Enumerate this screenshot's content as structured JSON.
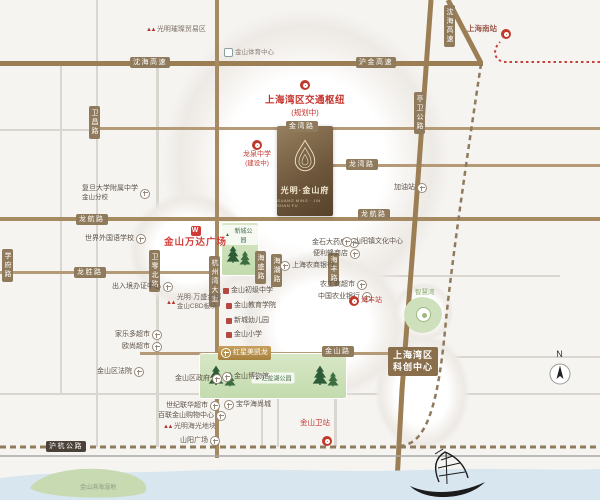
{
  "colors": {
    "accent_red": "#c23b35",
    "road_brown": "#9c7e55",
    "badge_brown": "#8f7a5c",
    "park_green": "#cfe0bd",
    "water_blue": "#d8e6ef",
    "gold": "#b8935a"
  },
  "map": {
    "compass_n": "N",
    "project": {
      "name": "光明·金山府",
      "name_en": "GUANG MING · JIN SHAN FU"
    },
    "hub": {
      "line1": "上海湾区交通枢纽",
      "line2": "(规划中)"
    },
    "kechuang": {
      "line1": "上海湾区",
      "line2": "科创中心"
    },
    "parks": {
      "xincheng": "新城公园",
      "huilong": "汇龙湖公园"
    },
    "road_badges": [
      {
        "text": "沈海高速",
        "x": 130,
        "y": 57
      },
      {
        "text": "沪金高速",
        "x": 356,
        "y": 57
      },
      {
        "text": "沈海高速",
        "x": 444,
        "y": 5,
        "vertical": true
      },
      {
        "text": "亭卫公路",
        "x": 414,
        "y": 92,
        "vertical": true
      },
      {
        "text": "卫昌路",
        "x": 89,
        "y": 106,
        "vertical": true
      },
      {
        "text": "金湾路",
        "x": 286,
        "y": 121
      },
      {
        "text": "龙湾路",
        "x": 346,
        "y": 159
      },
      {
        "text": "龙航路",
        "x": 76,
        "y": 214
      },
      {
        "text": "龙航路",
        "x": 358,
        "y": 209
      },
      {
        "text": "龙胜路",
        "x": 74,
        "y": 267
      },
      {
        "text": "学府路",
        "x": 2,
        "y": 249,
        "vertical": true
      },
      {
        "text": "卫零北路",
        "x": 149,
        "y": 250,
        "vertical": true
      },
      {
        "text": "杭州湾大道",
        "x": 209,
        "y": 256,
        "vertical": true
      },
      {
        "text": "海盛路",
        "x": 255,
        "y": 251,
        "vertical": true
      },
      {
        "text": "海潮路",
        "x": 271,
        "y": 254,
        "vertical": true
      },
      {
        "text": "海丰路",
        "x": 328,
        "y": 253,
        "vertical": true
      },
      {
        "text": "金山路",
        "x": 322,
        "y": 346
      },
      {
        "text": "沪杭公路",
        "x": 46,
        "y": 441,
        "dark": true
      }
    ],
    "pois": [
      {
        "id": "guangming-cuican-logo",
        "text": "光明璀璨贸易区",
        "icon": "brand-logo",
        "x": 146,
        "y": 26,
        "color": "#7d6f63"
      },
      {
        "id": "jinshan-sports-center",
        "text": "金山体育中心",
        "icon": "dot",
        "x": 224,
        "y": 48,
        "color": "#8a8178",
        "size": 6.5
      },
      {
        "id": "shanghai-south-station",
        "text": "上海南站",
        "x": 467,
        "y": 24,
        "color": "#9a5a4c",
        "size": 7.5,
        "bold": true
      },
      {
        "id": "shanghai-south-station-icon",
        "text": "",
        "icon": "rail",
        "x": 501,
        "y": 29
      },
      {
        "id": "longquan-school",
        "text": "龙泉中学",
        "sub": "(建设中)",
        "icon": "rail",
        "x": 243,
        "y": 140,
        "color": "#c23b35",
        "stack": true
      },
      {
        "id": "gas-station",
        "text": "加油站",
        "icon": "cross",
        "iconSide": "right",
        "x": 394,
        "y": 183
      },
      {
        "id": "fudan-affiliated",
        "text": "复旦大学附属中学",
        "sub": "金山分校",
        "icon": "cross",
        "iconSide": "right",
        "x": 82,
        "y": 185
      },
      {
        "id": "wanda-plaza",
        "text": "金山万达广场",
        "icon": "wanda",
        "x": 164,
        "y": 226,
        "color": "#d23f3a",
        "size": 9.5,
        "bold": true,
        "stack": true,
        "ls": 1
      },
      {
        "id": "world-foreign-school",
        "text": "世界外国语学校",
        "icon": "cross",
        "iconSide": "right",
        "x": 85,
        "y": 234
      },
      {
        "id": "exit-entry-center",
        "text": "出入境办证中心",
        "icon": "cross",
        "iconSide": "right",
        "x": 112,
        "y": 282
      },
      {
        "id": "wansheng-jindi",
        "text": "光明·万盛金邸",
        "sub": "金山CBD板块",
        "icon": "brand-logo",
        "x": 166,
        "y": 294,
        "color": "#6f635a"
      },
      {
        "id": "jinshan-junior-school",
        "text": "金山初级中学",
        "icon": "reddot",
        "x": 223,
        "y": 287
      },
      {
        "id": "jinshan-edu-college",
        "text": "金山教育学院",
        "icon": "reddot",
        "x": 226,
        "y": 302
      },
      {
        "id": "xincheng-kindergarten",
        "text": "新城幼儿园",
        "icon": "reddot",
        "x": 226,
        "y": 317
      },
      {
        "id": "jinshan-primary",
        "text": "金山小学",
        "icon": "reddot",
        "x": 226,
        "y": 331
      },
      {
        "id": "jinshi-pharmacy",
        "text": "金石大药房",
        "icon": "cross",
        "iconSide": "right",
        "x": 312,
        "y": 238
      },
      {
        "id": "convenience-store",
        "text": "便利蜂商店",
        "icon": "cross",
        "iconSide": "right",
        "x": 313,
        "y": 249
      },
      {
        "id": "rural-commercial-bank",
        "text": "上海农商银行",
        "icon": "cross",
        "x": 280,
        "y": 261
      },
      {
        "id": "shanyang-culture-center",
        "text": "山阳镇文化中心",
        "icon": "cross",
        "x": 342,
        "y": 237
      },
      {
        "id": "nonggongshang-market",
        "text": "农工商超市",
        "icon": "cross",
        "iconSide": "right",
        "x": 320,
        "y": 280
      },
      {
        "id": "agricultural-bank",
        "text": "中国农业银行",
        "icon": "cross",
        "iconSide": "right",
        "x": 318,
        "y": 292
      },
      {
        "id": "haifeng-station",
        "text": "海丰站",
        "icon": "rail",
        "x": 349,
        "y": 296,
        "color": "#c23b35"
      },
      {
        "id": "jiale-market",
        "text": "家乐多超市",
        "icon": "cross",
        "iconSide": "right",
        "x": 115,
        "y": 330
      },
      {
        "id": "auchan-market",
        "text": "欧尚超市",
        "icon": "cross",
        "iconSide": "right",
        "x": 122,
        "y": 342
      },
      {
        "id": "jinshan-court",
        "text": "金山区法院",
        "icon": "cross",
        "iconSide": "right",
        "x": 97,
        "y": 367
      },
      {
        "id": "jinshan-government",
        "text": "金山区政府",
        "icon": "cross",
        "iconSide": "right",
        "x": 175,
        "y": 374
      },
      {
        "id": "jinshan-museum",
        "text": "金山博物馆",
        "icon": "cross",
        "x": 222,
        "y": 372
      },
      {
        "id": "baohua-haishang",
        "text": "宝华海尚城",
        "icon": "cross",
        "x": 224,
        "y": 400
      },
      {
        "id": "shiji-lianhua-market",
        "text": "世纪联华超市",
        "icon": "cross",
        "iconSide": "right",
        "x": 166,
        "y": 401
      },
      {
        "id": "bailian-mall",
        "text": "百联金山购物中心",
        "icon": "cross",
        "iconSide": "right",
        "x": 158,
        "y": 411
      },
      {
        "id": "haiguang-plot",
        "text": "光明海光地块",
        "icon": "brand-logo",
        "x": 163,
        "y": 423,
        "color": "#6f635a"
      },
      {
        "id": "shanyang-square",
        "text": "山阳广场",
        "icon": "cross",
        "iconSide": "right",
        "x": 180,
        "y": 436
      },
      {
        "id": "jinshanwei-station-label",
        "text": "金山卫站",
        "x": 300,
        "y": 418,
        "color": "#c23b35",
        "size": 7.5
      },
      {
        "id": "jinshanwei-station-icon",
        "text": "",
        "icon": "rail",
        "x": 322,
        "y": 436
      },
      {
        "id": "zhihuiwan-label",
        "text": "智慧湾",
        "x": 415,
        "y": 289,
        "color": "#89a96d",
        "size": 6.5
      },
      {
        "id": "hongxing-macalline",
        "text": "红星美凯龙",
        "icon": "cross",
        "x": 218,
        "y": 346,
        "gold": true
      },
      {
        "id": "binhai-wetland-label",
        "text": "金山滨海湿地",
        "x": 80,
        "y": 485,
        "color": "#8a9a80",
        "size": 6
      }
    ]
  }
}
